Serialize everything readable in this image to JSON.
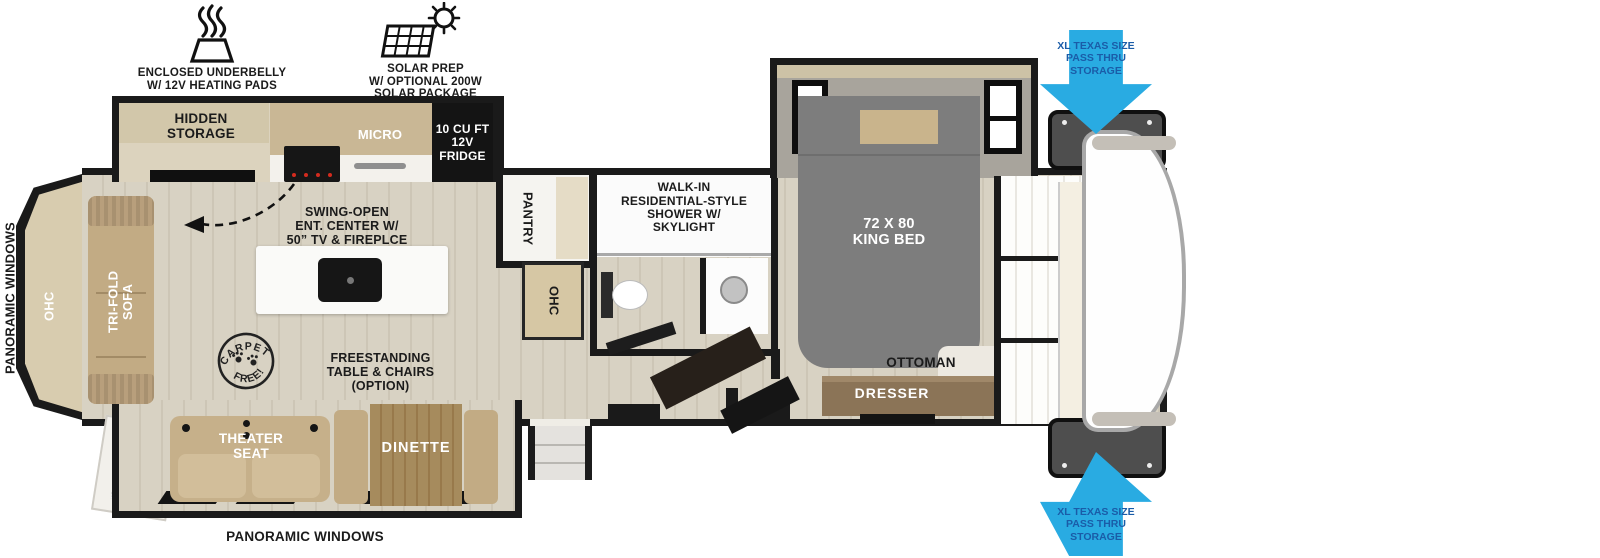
{
  "title": "Fifth wheel RV floorplan",
  "colors": {
    "arrow-blue": "#29ABE2",
    "arrow-text": "#1A5CA8",
    "wall": "#1A1A1A",
    "floor-light": "#D8D2C3",
    "floor-stripe": "#CDC6B6",
    "counter-tan": "#C9B795",
    "cabinet-beige": "#D8CCAF",
    "sofa-tan": "#C2AB84",
    "bed-gray": "#7D7D7D",
    "slide-gray": "#A8A49C",
    "table-brown": "#A68B5D",
    "dresser-brown": "#8B7457"
  },
  "callouts": {
    "underbelly": "ENCLOSED UNDERBELLY\nW/ 12V HEATING PADS",
    "solar": "SOLAR PREP\nW/ OPTIONAL 200W\nSOLAR PACKAGE",
    "pass_thru_top": "XL TEXAS SIZE\nPASS THRU\nSTORAGE",
    "pass_thru_bottom": "XL TEXAS SIZE\nPASS THRU\nSTORAGE"
  },
  "labels": {
    "panoramic_left": "PANORAMIC WINDOWS",
    "panoramic_bottom": "PANORAMIC WINDOWS",
    "hidden_storage": "HIDDEN\nSTORAGE",
    "micro": "MICRO",
    "fridge": "10 CU FT\n12V\nFRIDGE",
    "ent_center": "SWING-OPEN\nENT. CENTER W/\n50” TV & FIREPLCE",
    "ohc_rear": "OHC",
    "tri_fold_sofa": "TRI-FOLD\nSOFA",
    "theater_seat": "THEATER\nSEAT",
    "dinette": "DINETTE",
    "freestanding_table": "FREESTANDING\nTABLE & CHAIRS\n(OPTION)",
    "pantry": "PANTRY",
    "ohc_mid": "OHC",
    "shower": "WALK-IN\nRESIDENTIAL-STYLE\nSHOWER W/\nSKYLIGHT",
    "king_bed": "72 X 80\nKING BED",
    "ottoman": "OTTOMAN",
    "dresser": "DRESSER",
    "dryer_prep": "DRYER\nPREP",
    "ward": "WARD",
    "washer_prep": "WASHER\nPREP"
  },
  "stamp": {
    "arc_top": "CARPET",
    "arc_bottom": "FREE!"
  }
}
